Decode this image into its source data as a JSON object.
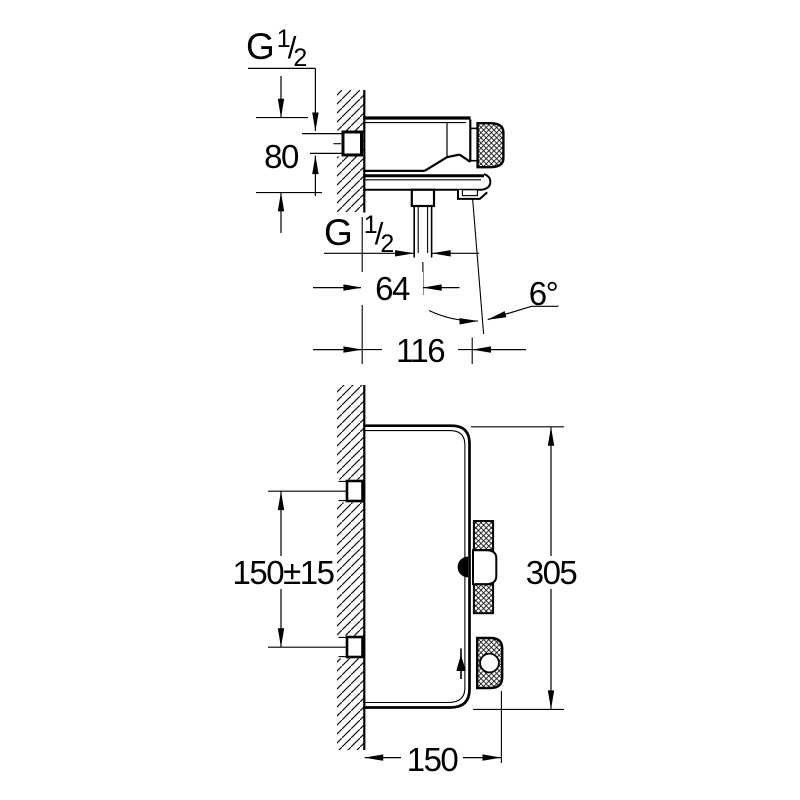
{
  "labels": {
    "top_view": {
      "inlet_thread": {
        "prefix": "G",
        "numerator": "1",
        "slash": "/",
        "denominator": "2"
      },
      "offset_80": "80",
      "outlet_thread": {
        "prefix": "G",
        "numerator": "1",
        "slash": "/",
        "denominator": "2"
      },
      "distance_64": "64",
      "angle_6": "6°",
      "reach_116": "116"
    },
    "front_view": {
      "spacing_150": "150±15",
      "height_305": "305",
      "width_150": "150"
    }
  },
  "colors": {
    "line": "#000000",
    "background": "#ffffff"
  }
}
